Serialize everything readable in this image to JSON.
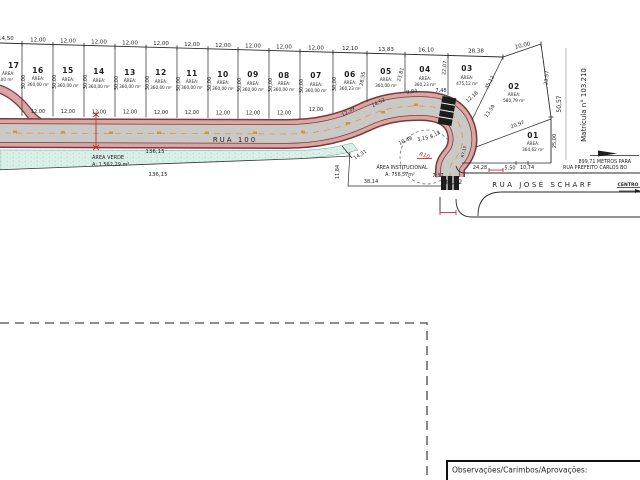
{
  "drawing": {
    "area_label": "ÁREA:",
    "lots": [
      {
        "n": "17",
        "a": "04,00 m²"
      },
      {
        "n": "16",
        "a": "360,00 m²"
      },
      {
        "n": "15",
        "a": "360,00 m²"
      },
      {
        "n": "14",
        "a": "360,00 m²"
      },
      {
        "n": "13",
        "a": "360,00 m²"
      },
      {
        "n": "12",
        "a": "360,00 m²"
      },
      {
        "n": "11",
        "a": "360,00 m²"
      },
      {
        "n": "10",
        "a": "360,00 m²"
      },
      {
        "n": "09",
        "a": "360,00 m²"
      },
      {
        "n": "08",
        "a": "360,00 m²"
      },
      {
        "n": "07",
        "a": "360,00 m²"
      },
      {
        "n": "06",
        "a": "360,23 m²"
      },
      {
        "n": "05",
        "a": "360,00 m²"
      },
      {
        "n": "04",
        "a": "360,23 m²"
      },
      {
        "n": "03",
        "a": "475,12 m²"
      },
      {
        "n": "02",
        "a": "580,79 m²"
      },
      {
        "n": "01",
        "a": "364,62 m²"
      }
    ],
    "top_dims": [
      "14,50",
      "12,00",
      "12,00",
      "12,00",
      "12,00",
      "12,00",
      "12,00",
      "12,00",
      "12,00",
      "12,00",
      "12,00",
      "12,10",
      "13,83",
      "16,10",
      "28,38",
      "10,00"
    ],
    "frontage_dims": [
      "12,00",
      "12,00",
      "12,00",
      "12,00",
      "12,00",
      "12,00",
      "12,00",
      "12,00",
      "12,00",
      "12,00"
    ],
    "depth_dims": [
      "30,00",
      "30,00",
      "30,00",
      "30,00",
      "30,00",
      "30,00",
      "30,00",
      "30,00",
      "30,00",
      "30,00",
      "30,00"
    ],
    "dims": {
      "d28_55": "28,55",
      "d23_81": "23,81",
      "d22_07": "22,07",
      "d23_57": "23,57",
      "d25_00": "25,00",
      "d50_57": "50,57",
      "d12_39": "12,39",
      "d14_52": "14,52",
      "d9_84": "9,84",
      "d7_48": "7,48",
      "d12_18": "12,18",
      "d13_59": "13,59",
      "d20_97": "20,97",
      "d35_12": "35,12",
      "d18_49": "18,49",
      "d3_15": "3,15",
      "d8_12": "8,12",
      "d7_37": "7,37",
      "d14_31": "14,31",
      "d11_84": "11,84",
      "d38_14": "38,14",
      "d24_28": "24,28",
      "d5_50": "5,50",
      "d10_74": "10,74",
      "d35_02": "35,02",
      "d136_15_a": "136,15",
      "d136_15_b": "136,15",
      "r10": "R10",
      "r7_12": "R7,12"
    },
    "rua100": "RUA 100",
    "area_verde": {
      "title": "ÁREA VERDE",
      "area": "A: 1.562,29 m²"
    },
    "institucional": {
      "title": "ÁREA INSTITUCIONAL",
      "area": "A: 756,57m²"
    },
    "matricula": "Matrícula n° 103.210",
    "rua_jose_scharf": {
      "name": "RUA JOSÉ SCHARF",
      "centro": "CENTRO",
      "note1": "899,71 METROS PARA",
      "note2": "RUA PREFEITO CARLOS BO"
    }
  },
  "observacoes_label": "Observações/Carimbos/Aprovações:",
  "colors": {
    "curb_edge": "#7a3a3a",
    "curb_fill": "#d9a6a3",
    "road": "#cbc9c6",
    "green": "#dcf0ea",
    "accent_red": "#c23030",
    "accent_orange": "#d4913f"
  }
}
